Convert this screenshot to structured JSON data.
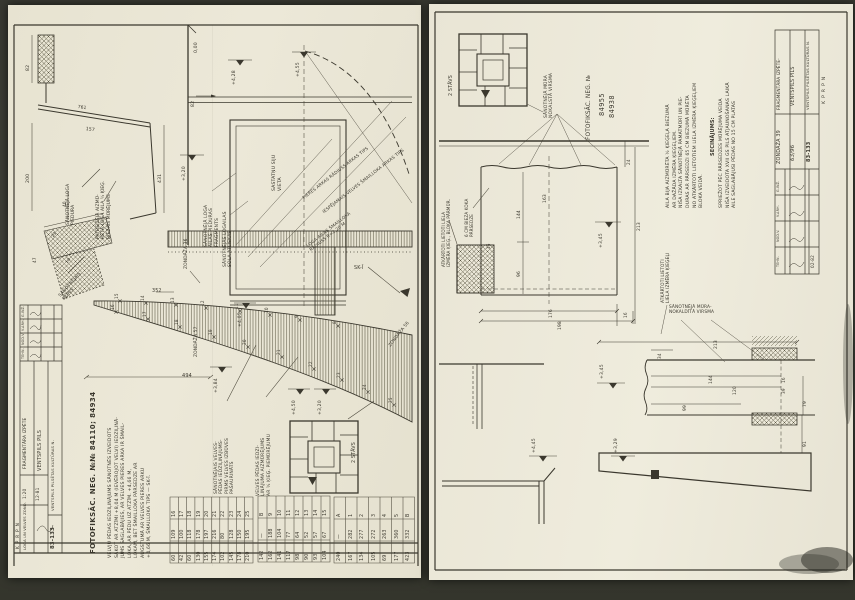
{
  "photo": {
    "background": "#3a3b31",
    "paper_left": "#e9e5d3",
    "paper_right": "#ebe8d8",
    "ink": "#3b382e"
  },
  "left": {
    "photo_ref": "FOTOFIKSĀC. NEG. №№ 84110; 84934",
    "paragraph": "VELVJU PĒDAS IEDZIĻINĀJUMS SĀNOTNĒS IZVEIDOTS\nSĀKOT AR ATZĪMI +8,04 M (IEVĒROJOT VELVI) IEDZIĻINĀ-\nJUMS SAGLABĀJIES, AR VELVES PIERES ARKA IR ŠMAIL-\nLOKA, AR PĒDU UZ ATZĪM. +4,66 M,\nLOKAM, BET ŠMAILLOKA PĀRSEDZE AR\nAUGSTUMĀ AR VELVES PIERES ARKU\n+4,66 M, ŠMAILLOKA TIPS — SK-Ī.",
    "elev": {
      "e000": "0,00",
      "e428": "+4,28",
      "e455": "+4,55",
      "e320": "+3,20",
      "e405": "+4,05",
      "e384": "+3,84",
      "e450": "+4,50",
      "e320b": "+3,20"
    },
    "dims": {
      "d82": "82",
      "d82b": "82",
      "d761": "761",
      "d157": "157",
      "d200": "200",
      "d431": "431",
      "d40": "40",
      "d23": "23",
      "d47": "47",
      "d18": "18",
      "d352": "352",
      "d494": "494"
    },
    "labels": {
      "piedura_fragments": "SĀNOTNĒJĀ LOGA\nAILAS PIEDURAS\nFRAGMENTS",
      "sola_atliekas": "SĀNOTNĒJĀS LOGAILAS\nSOLA ATLIEKAS",
      "sastatnu": "SASTATŅU SIJU\nVIETA",
      "pieres_arkas": "PIERES ARKAS RĀDIUSS ARKAS TIPS",
      "iespejamais": "IESPĒJAMAIS VELVES ŠMAILLOKA ARKAS TIPS",
      "loga_ailas_radiuss": "LOGA AILAS ŠMAILLOKA\nRĀDIUSS R≈2,20 M",
      "patreizeja": "PATREIZĒJĀ AIZMŪ-\nRĒTĀ LOGA AILA ½ ĶIEĢ.\nBIEZAIS MŪRĒJUMS",
      "loga_piedura": "SĀNOTNĒJĀ LOGA\nPIEDURA",
      "sanotnejais_muris": "SĀNOTNĒJAIS\nMŪRIS",
      "velves_pedas_iedz": "SĀNOTNĒJAIS VELVES-\nPĒDAS IEDZIĻINĀJUMS-\nPIRMS VELVES IZBŪVES\nPAŠAURINĀTS",
      "velves_pedas_aizm": "VELVES PĒDAS IEDZI-\nĻINĀJUMA AIZMŪRĒJUMS\nAR ½ ĶIEĢ. PIEMŪRĒJUMU",
      "zond36": "ZONDĀŽA 36",
      "zond57": "ZONDĀŽA 57",
      "zond56": "ZONDĀŽA 56",
      "sk1": "SK-Ī",
      "keyplan": "2 STĀVS"
    },
    "arch_points": [
      "8",
      "9",
      "10",
      "11",
      "12",
      "13",
      "14",
      "15",
      "16",
      "17",
      "18",
      "19",
      "20",
      "21",
      "22",
      "23",
      "24",
      "25"
    ],
    "tables": [
      {
        "rows": [
          [
            "A",
            "—",
            "240"
          ],
          [
            "1",
            "282",
            "167"
          ],
          [
            "2",
            "277",
            "134"
          ],
          [
            "3",
            "272",
            "105"
          ],
          [
            "4",
            "263",
            "69"
          ],
          [
            "5",
            "360",
            "177"
          ],
          [
            "B",
            "332",
            "423"
          ]
        ]
      },
      {
        "rows": [
          [
            "B",
            "—",
            "142"
          ],
          [
            "9",
            "188",
            "162"
          ],
          [
            "10",
            "104",
            "141"
          ],
          [
            "11",
            "77",
            "117"
          ],
          [
            "12",
            "64",
            "98"
          ],
          [
            "13",
            "52",
            "90"
          ],
          [
            "14",
            "57",
            "93"
          ],
          [
            "15",
            "67",
            "104"
          ]
        ]
      },
      {
        "rows": [
          [
            "16",
            "109",
            "60"
          ],
          [
            "17",
            "100",
            "42"
          ],
          [
            "18",
            "118",
            "60"
          ],
          [
            "19",
            "178",
            "130"
          ],
          [
            "20",
            "197",
            "155"
          ],
          [
            "21",
            "216",
            "174"
          ],
          [
            "22",
            "80",
            "102"
          ],
          [
            "23",
            "128",
            "145"
          ],
          [
            "24",
            "150",
            "178"
          ],
          [
            "25",
            "195",
            "210"
          ]
        ]
      }
    ],
    "titleblock": {
      "org": "VENTSPILS PILSĒTAS KULTŪRAS N.",
      "doc_no": "83-133",
      "project": "VENTSPILS PILS",
      "stage": "FRAGMENTĀRA IZPĒTE",
      "sheet": "LOGA UN VELVES ZOND.",
      "date": "12-81",
      "scale": "1:20",
      "org2": "KPRPN",
      "roles": [
        "G.INŽ.",
        "V.ARH.",
        "NOD.V.",
        "TEHN."
      ]
    }
  },
  "right": {
    "paragraph": "AILA BIJA AIZMŪRĒTA ½ ĶIEĢEĻA BIEZUMĀ\nAR DAŽĀDA IZMĒRA ĶIEĢEĻIEM.\nNIŠA IZKALTA SĀNOTNĒJĀ PAMATMŪRĪ UN PIE-\nDURAS AR PĀRSEDZI 65 CM BIEZUMĀ MŪRĒTA\nNO ATKĀRTOTI LIETOTIEM LIELA IZMĒRA ĶIEĢEĻIEM\nBLOKA VEIDĀ.",
    "conclusion_head": "SECINĀJUMS:",
    "conclusion": "SPRIEŽOT PĒC PĀRSEDZES MŪRĒJUMA VEIDA\nNIŠA IZVEIDOTA XVII GS PILS ATJAUNOŠANAS LAIKĀ\nAILE SAGLABĀJUSI PĒDAS NO 15 CM PLATAS",
    "elev": {
      "e345": "+3,45",
      "e345b": "+3,45",
      "e329": "+3,29",
      "e445": "+4,45"
    },
    "dims": {
      "d163": "163",
      "d144": "144",
      "d96": "96",
      "d15": "15",
      "d24": "24",
      "d213": "213",
      "d176": "176",
      "d198": "198",
      "d16": "16",
      "d213b": "213",
      "d34": "34",
      "d144b": "144",
      "d120": "120",
      "d99": "99",
      "d16b": "16",
      "d39": "39",
      "d79": "79",
      "d91": "91"
    },
    "labels": {
      "keyplan": "2 STĀVS",
      "nokalsta": "SĀNOTNĒJĀ MŪRA\nNOKALSTĀ VIRSMA",
      "photo_ref": "FOTOFIKSĀC. NEG. №",
      "neg1": "84955",
      "neg2": "84938",
      "atkartoti_bloka": "ATKĀRTOTI LIETOTI LIELA\nIZMĒRA ĶIEĢ., BLOKA PĀRMŪR.",
      "koka_parsedze": "6 CM BIEZA KOKA\nPĀRSEDZE",
      "atkartoti_kiegeli": "ATKĀRTOTI LIETOTI\nLIELA IZMĒRA ĶIEĢEĻI",
      "nokaldita": "SĀNOTNĒJĀ MŪRA-\nNOKALDĪTĀ VIRSMA"
    },
    "titleblock": {
      "org": "VENTSPILS PILSĒTAS KULTŪRAS N.",
      "doc_no": "83-133",
      "extra_no": "63/96",
      "project": "VENTSPILS PILS",
      "stage": "FRAGMENTĀRA IZPĒTE-",
      "sheet": "ZONDĀŽA 39",
      "date": "02-82",
      "org2": "KPRPN",
      "roles": [
        "G.INŽ.",
        "V.ARH.",
        "NOD.V.",
        "TEHN."
      ]
    }
  }
}
